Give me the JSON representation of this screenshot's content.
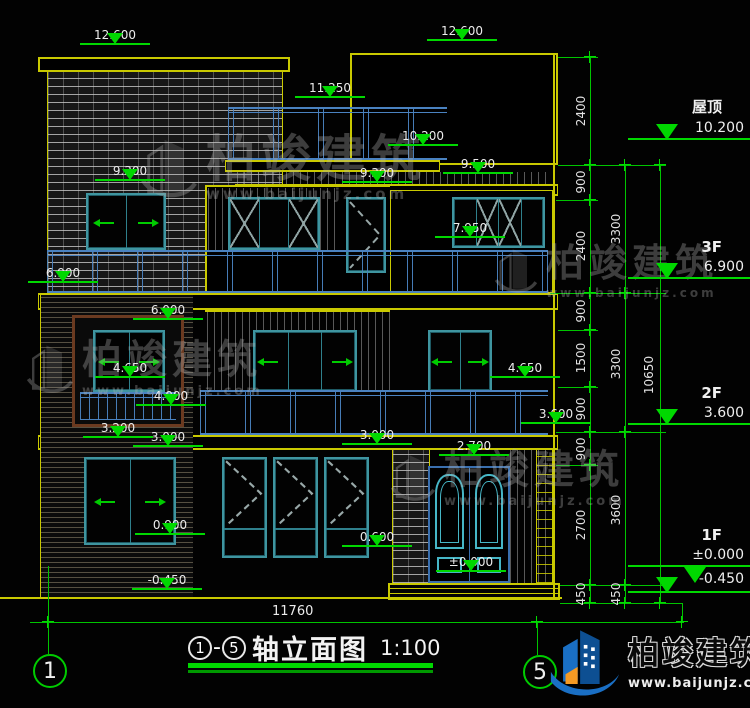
{
  "levels": {
    "v12600": "12.600",
    "v11250": "11.250",
    "v10200": "10.200",
    "v9500": "9.500",
    "v9300": "9.300",
    "v7950": "7.950",
    "v6900": "6.900",
    "v6000": "6.000",
    "v4650": "4.650",
    "v4000": "4.000",
    "v3600": "3.600",
    "v3200": "3.200",
    "v3000": "3.000",
    "v2700": "2.700",
    "v0900": "0.900",
    "v0600": "0.600",
    "v0000": "±0.000",
    "vm0450": "-0.450"
  },
  "right_panel": {
    "floors": [
      {
        "label": "屋顶",
        "elev": "10.200"
      },
      {
        "label": "3F",
        "elev": "6.900"
      },
      {
        "label": "2F",
        "elev": "3.600"
      },
      {
        "label": "1F",
        "elev": "±0.000",
        "elev_below": "-0.450"
      }
    ],
    "chain_inner": [
      "2400",
      "900",
      "2400",
      "900",
      "1500",
      "900",
      "900",
      "2700",
      "450"
    ],
    "chain_mid": [
      "3300",
      "3300",
      "3600",
      "450"
    ],
    "chain_total": "10650"
  },
  "bottom_dim": "11760",
  "axis_bubbles": {
    "left": "1",
    "right": "5"
  },
  "title": {
    "axis_start": "1",
    "dash": "-",
    "axis_end": "5",
    "name": "轴立面图",
    "scale": "1:100"
  },
  "watermark": {
    "name": "柏竣建筑",
    "url": "www.baijunjz.com"
  },
  "logo": {
    "name": "柏竣建筑",
    "url": "www.baijunjz.com"
  }
}
